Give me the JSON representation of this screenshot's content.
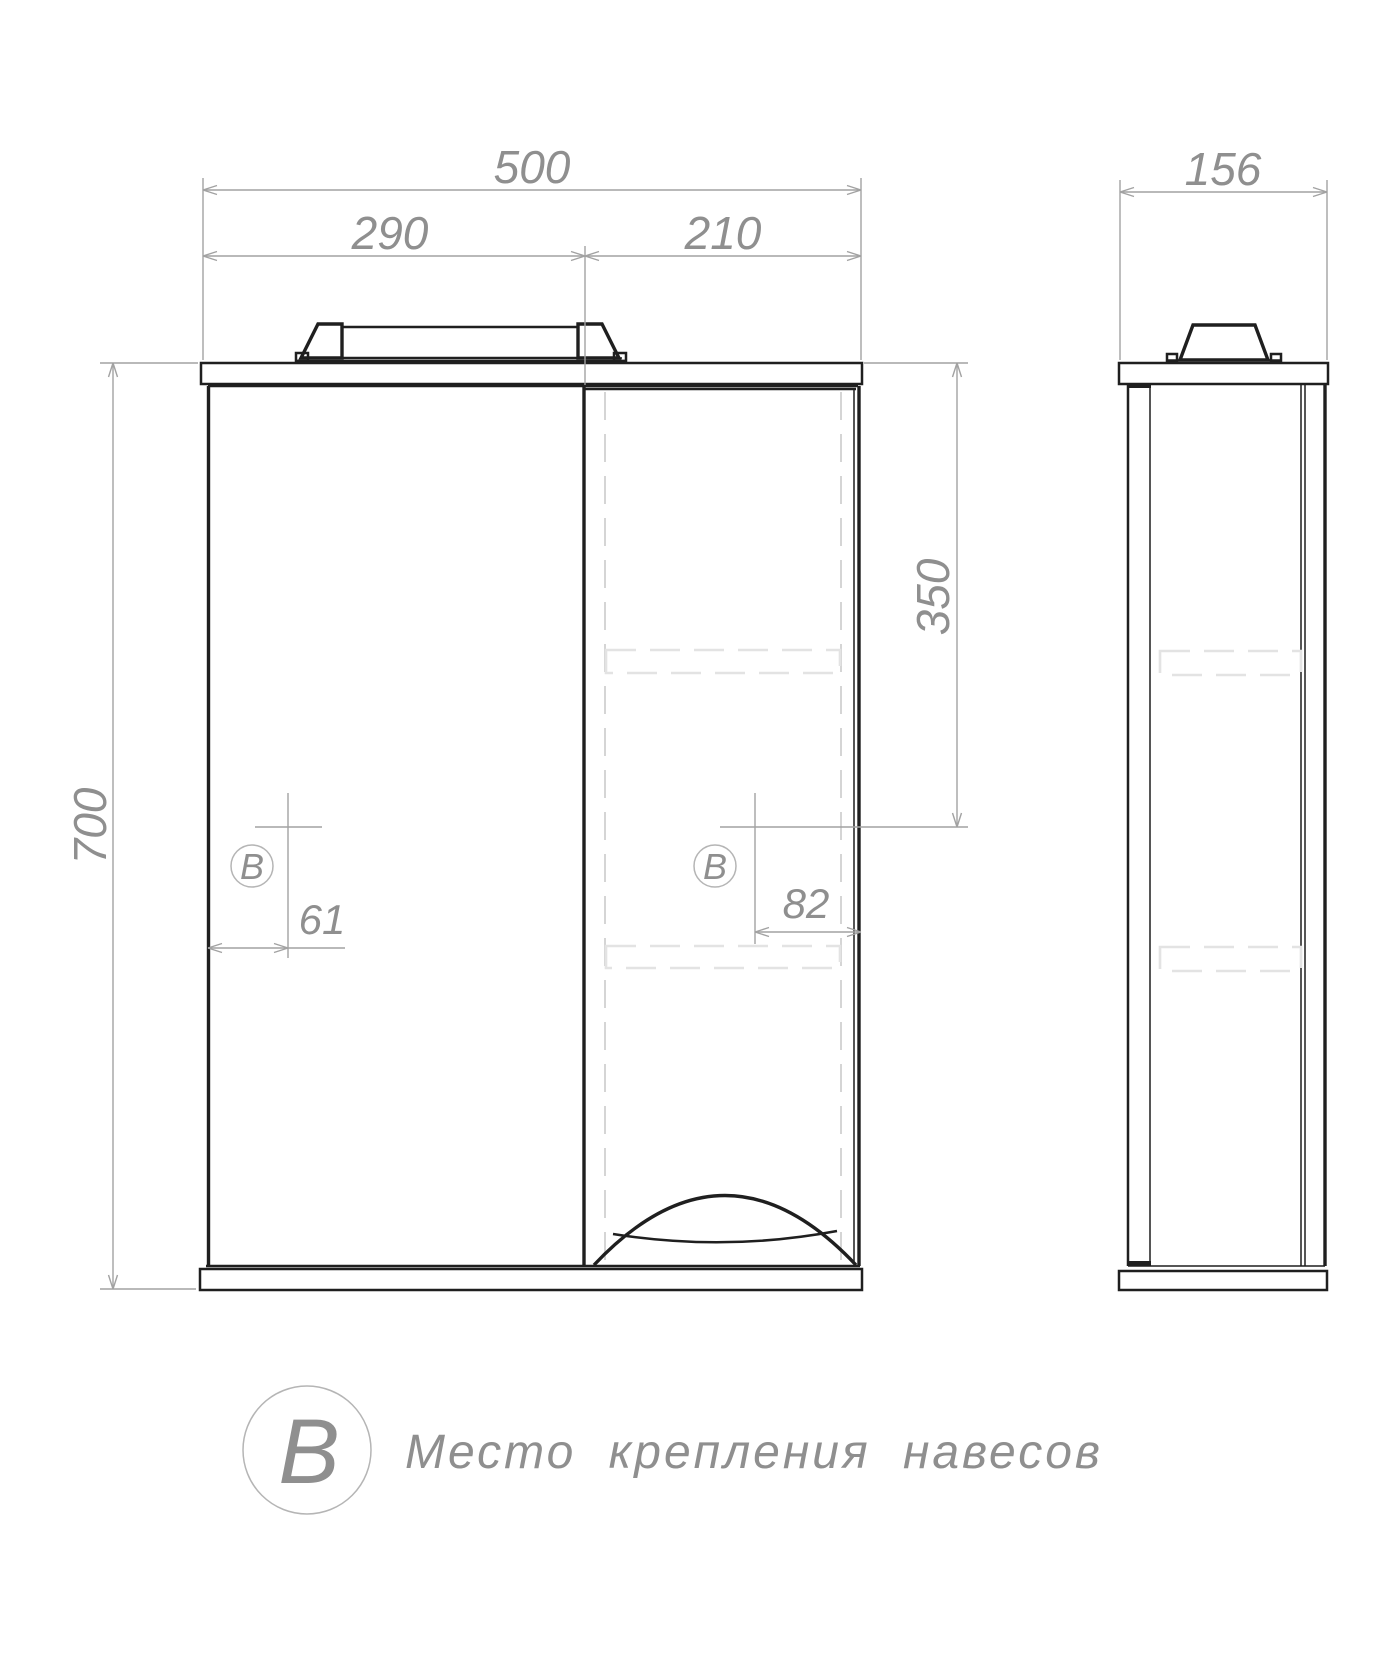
{
  "drawing": {
    "type": "furniture technical drawing, mirror cabinet",
    "colors": {
      "ink": "#1f1f1f",
      "dimension": "#a2a2a2",
      "hidden_line": "#d5d5d5",
      "background": "#ffffff"
    },
    "dims": {
      "total_width": "500",
      "left_section": "290",
      "right_section": "210",
      "depth": "156",
      "height": "700",
      "mount_top_offset": "350",
      "mount_left_offset": "61",
      "mount_right_offset": "82"
    },
    "marker": {
      "symbol": "B"
    },
    "legend": {
      "symbol": "B",
      "text": "Место крепления навесов"
    }
  }
}
